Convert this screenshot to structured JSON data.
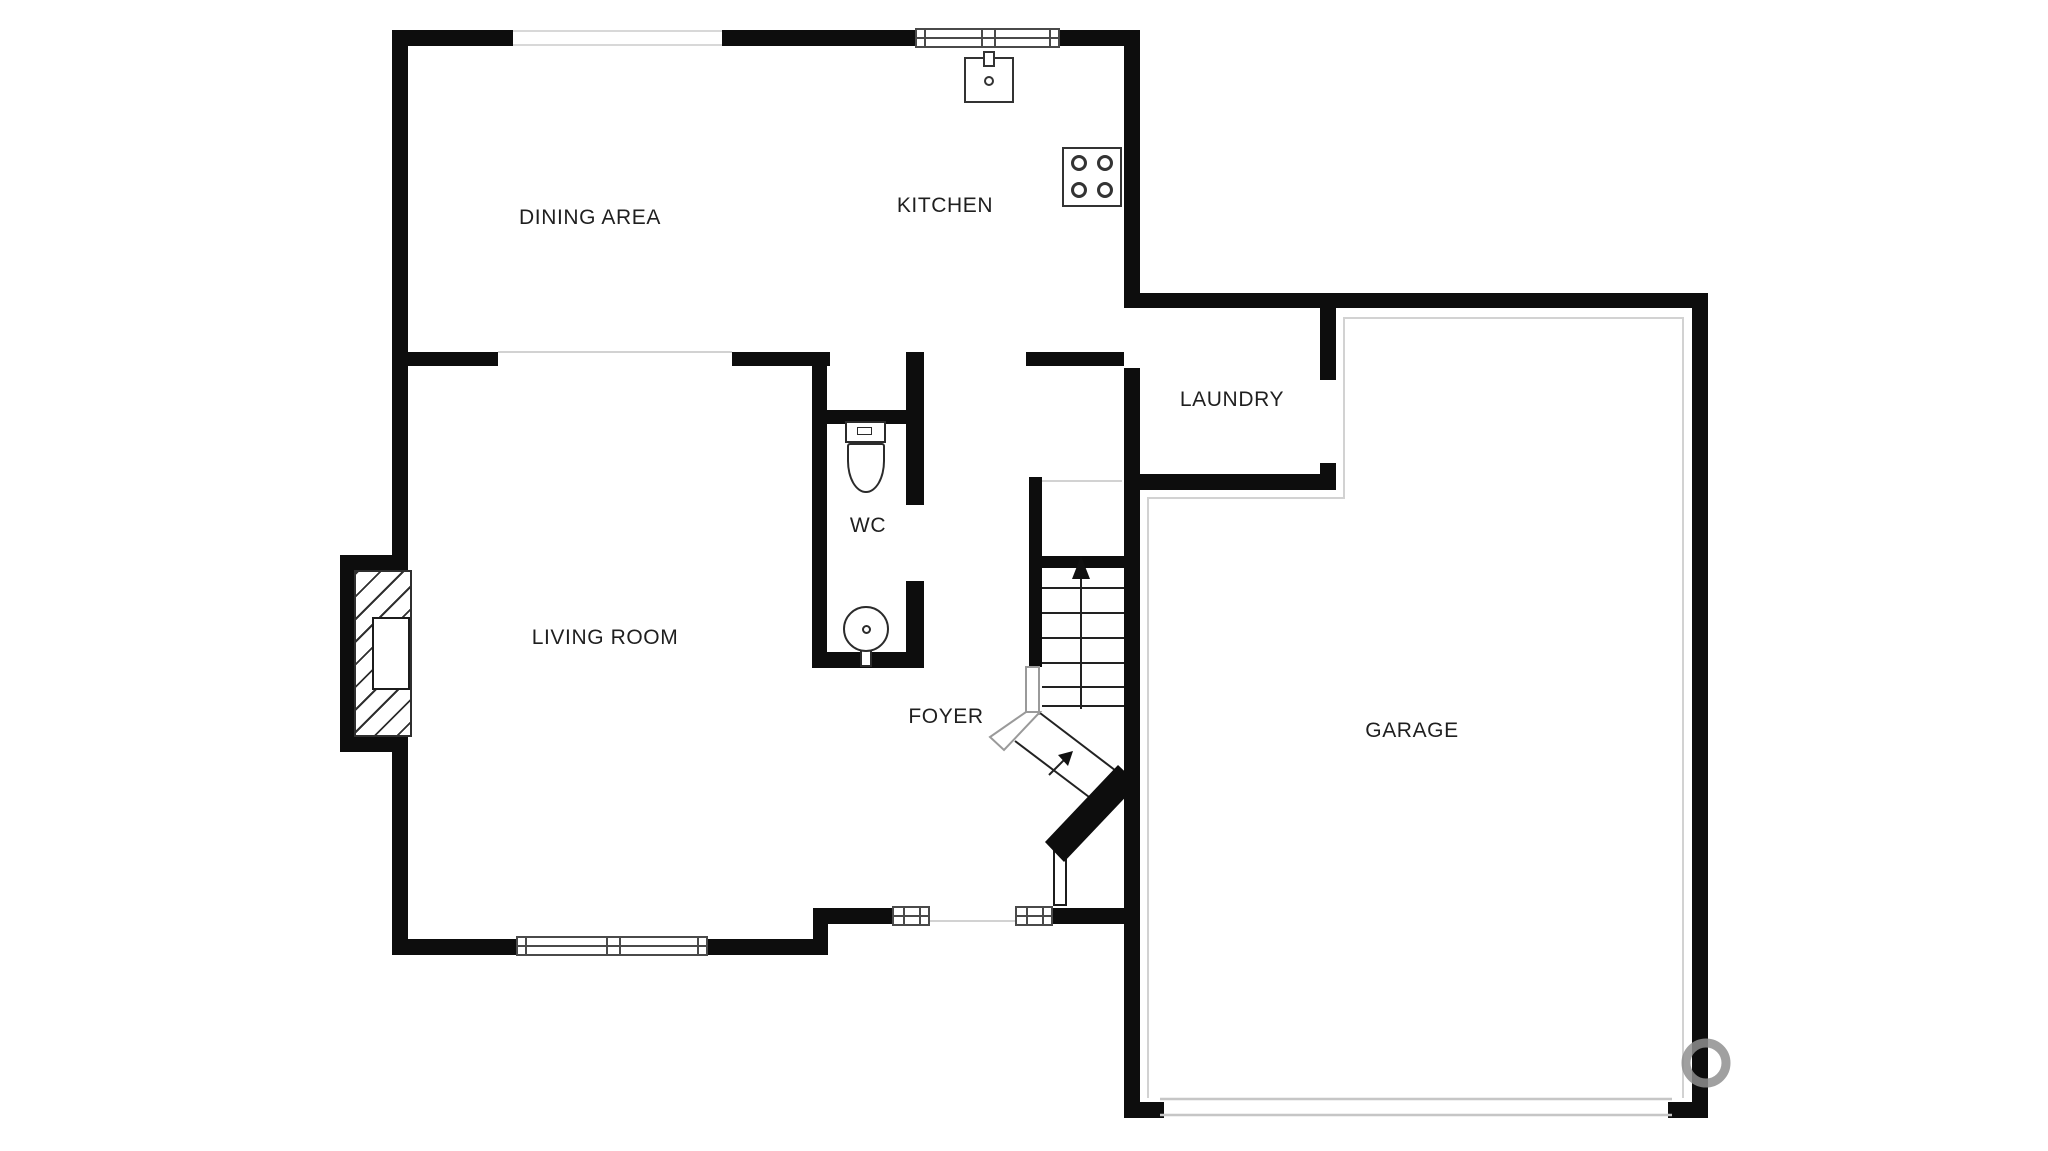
{
  "plan": {
    "type": "residential-floor-plan",
    "rooms": [
      {
        "name": "DINING AREA"
      },
      {
        "name": "KITCHEN"
      },
      {
        "name": "LAUNDRY"
      },
      {
        "name": "WC"
      },
      {
        "name": "LIVING ROOM"
      },
      {
        "name": "FOYER"
      },
      {
        "name": "GARAGE"
      }
    ],
    "symbols": [
      "kitchen-sink-symbol",
      "kitchen-faucet-symbol",
      "stove-symbol",
      "toilet-symbol",
      "wc-sink-symbol",
      "fireplace-symbol",
      "staircase-symbol",
      "stair-direction-arrow",
      "winder-stairs-symbol",
      "front-door-leaf-symbol",
      "garage-door-symbol",
      "window-symbol",
      "watermark-ring"
    ],
    "palette": {
      "wall": "#0d0d0d",
      "thin_line": "#d2d2d2",
      "window_frame": "#4a4a4a",
      "fixture_outline": "#2b2b2b",
      "label_text": "#1f1f1f",
      "background": "#ffffff",
      "watermark": "#8f8f8f"
    }
  }
}
